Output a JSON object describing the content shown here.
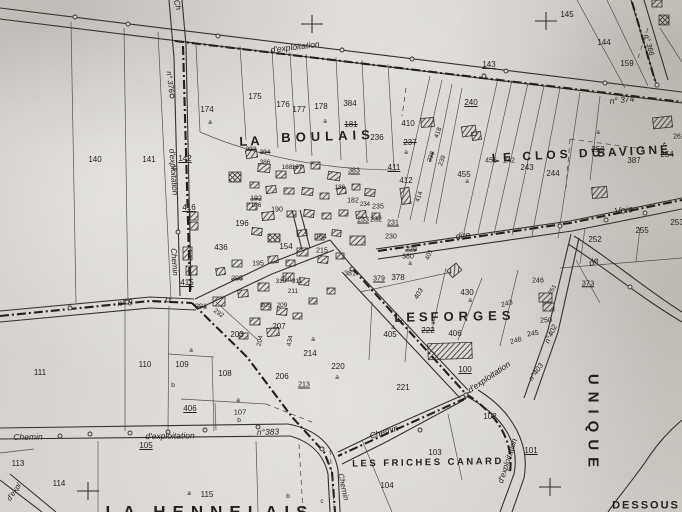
{
  "map": {
    "type": "cadastral-map-scan",
    "palette": {
      "paper": "#d6d4d0",
      "ink": "#2c2a25",
      "boundary": "#232019"
    },
    "place_labels": [
      {
        "text": "LA",
        "x": 251,
        "y": 141,
        "fs": 13,
        "ls": 3,
        "rot": -2
      },
      {
        "text": "BOULAIS",
        "x": 328,
        "y": 136,
        "fs": 13,
        "ls": 5,
        "rot": -2
      },
      {
        "text": "LE CLOS DU",
        "x": 548,
        "y": 155,
        "fs": 12,
        "ls": 4,
        "rot": -3
      },
      {
        "text": "SAVIGNÉ",
        "x": 634,
        "y": 151,
        "fs": 12,
        "ls": 3,
        "rot": -3
      },
      {
        "text": "LES",
        "x": 413,
        "y": 317,
        "fs": 13,
        "ls": 4,
        "rot": -1
      },
      {
        "text": "FORGES",
        "x": 473,
        "y": 316,
        "fs": 13,
        "ls": 5,
        "rot": -1
      },
      {
        "text": "LES FRICHES CANARD",
        "x": 428,
        "y": 463,
        "fs": 9.5,
        "ls": 2.5,
        "rot": -1
      },
      {
        "text": "LA HENNELAIS",
        "x": 210,
        "y": 512,
        "fs": 17,
        "ls": 7,
        "rot": 0
      },
      {
        "text": "UNIQUE",
        "x": 593,
        "y": 424,
        "fs": 15,
        "ls": 7,
        "rot": 90
      },
      {
        "text": "DESSOUS",
        "x": 646,
        "y": 506,
        "fs": 11,
        "ls": 2,
        "rot": 0
      }
    ],
    "road_labels": [
      {
        "text": "Ch",
        "x": 177,
        "y": 5,
        "fs": 8,
        "rot": 75
      },
      {
        "text": "d'exploitation",
        "x": 295,
        "y": 47,
        "fs": 8.5,
        "rot": -7
      },
      {
        "text": "n° 374",
        "x": 622,
        "y": 100,
        "fs": 8.5,
        "rot": -6
      },
      {
        "text": "n° 366",
        "x": 649,
        "y": 45,
        "fs": 7.5,
        "rot": 75
      },
      {
        "text": "n° 376",
        "x": 170,
        "y": 82,
        "fs": 7.5,
        "rot": 83
      },
      {
        "text": "d'exploitation",
        "x": 173,
        "y": 172,
        "fs": 8,
        "rot": 86
      },
      {
        "text": "Chemin",
        "x": 174,
        "y": 262,
        "fs": 8,
        "rot": 86
      },
      {
        "text": "n° 8",
        "x": 125,
        "y": 303,
        "fs": 8.5,
        "rot": -5
      },
      {
        "text": "Chemin",
        "x": 28,
        "y": 437,
        "fs": 8.5,
        "rot": -1
      },
      {
        "text": "d'exploitation",
        "x": 170,
        "y": 436,
        "fs": 8.5,
        "rot": -1
      },
      {
        "text": "n°383",
        "x": 268,
        "y": 432,
        "fs": 8.5,
        "rot": -2
      },
      {
        "text": "d'expl",
        "x": 14,
        "y": 492,
        "fs": 7.5,
        "rot": -55
      },
      {
        "text": "Chemin",
        "x": 384,
        "y": 432,
        "fs": 8.5,
        "rot": -17
      },
      {
        "text": "d'exploitation",
        "x": 489,
        "y": 377,
        "fs": 8.5,
        "rot": -34
      },
      {
        "text": "d'exploitation",
        "x": 508,
        "y": 461,
        "fs": 8,
        "rot": -72
      },
      {
        "text": "n°403",
        "x": 536,
        "y": 372,
        "fs": 7.5,
        "rot": -55
      },
      {
        "text": "n°402",
        "x": 551,
        "y": 334,
        "fs": 7.5,
        "rot": -65
      },
      {
        "text": "403",
        "x": 419,
        "y": 294,
        "fs": 7,
        "rot": -60
      },
      {
        "text": "Chemin",
        "x": 343,
        "y": 487,
        "fs": 8,
        "rot": 78
      },
      {
        "text": "dite",
        "x": 463,
        "y": 236,
        "fs": 9,
        "rot": -8
      },
      {
        "text": "Voie",
        "x": 624,
        "y": 211,
        "fs": 9.5,
        "rot": -9
      },
      {
        "text": "de",
        "x": 594,
        "y": 262,
        "fs": 9,
        "rot": -25
      }
    ],
    "parcel_labels": [
      {
        "text": "140",
        "x": 95,
        "y": 160
      },
      {
        "text": "141",
        "x": 149,
        "y": 160
      },
      {
        "text": "142",
        "x": 185,
        "y": 159,
        "deco": "und"
      },
      {
        "text": "174",
        "x": 207,
        "y": 110
      },
      {
        "text": "175",
        "x": 255,
        "y": 97
      },
      {
        "text": "176",
        "x": 283,
        "y": 105
      },
      {
        "text": "177",
        "x": 299,
        "y": 110
      },
      {
        "text": "178",
        "x": 321,
        "y": 107
      },
      {
        "text": "384",
        "x": 350,
        "y": 104
      },
      {
        "text": "181",
        "x": 351,
        "y": 125,
        "deco": "strike"
      },
      {
        "text": "236",
        "x": 377,
        "y": 138
      },
      {
        "text": "143",
        "x": 489,
        "y": 65,
        "deco": "und"
      },
      {
        "text": "145",
        "x": 567,
        "y": 15
      },
      {
        "text": "144",
        "x": 604,
        "y": 43
      },
      {
        "text": "159",
        "x": 627,
        "y": 64
      },
      {
        "text": "240",
        "x": 471,
        "y": 103,
        "deco": "und"
      },
      {
        "text": "410",
        "x": 408,
        "y": 124
      },
      {
        "text": "237",
        "x": 410,
        "y": 143,
        "deco": "strike"
      },
      {
        "text": "253",
        "x": 598,
        "y": 150,
        "deco": "strike"
      },
      {
        "text": "254",
        "x": 667,
        "y": 155,
        "deco": "strike"
      },
      {
        "text": "387",
        "x": 634,
        "y": 161
      },
      {
        "text": "456",
        "x": 491,
        "y": 161,
        "fs": 7
      },
      {
        "text": "242",
        "x": 509,
        "y": 161,
        "fs": 7
      },
      {
        "text": "243",
        "x": 527,
        "y": 168
      },
      {
        "text": "244",
        "x": 553,
        "y": 174
      },
      {
        "text": "455",
        "x": 464,
        "y": 175
      },
      {
        "text": "411",
        "x": 394,
        "y": 168,
        "deco": "und"
      },
      {
        "text": "412",
        "x": 406,
        "y": 181
      },
      {
        "text": "416",
        "x": 189,
        "y": 208,
        "deco": "und"
      },
      {
        "text": "436",
        "x": 221,
        "y": 248
      },
      {
        "text": "418",
        "x": 439,
        "y": 133,
        "fs": 6.5,
        "rot": -70
      },
      {
        "text": "238",
        "x": 432,
        "y": 157,
        "fs": 6.5,
        "rot": -70,
        "deco": "strike"
      },
      {
        "text": "239",
        "x": 443,
        "y": 161,
        "fs": 6.5,
        "rot": -70
      },
      {
        "text": "414",
        "x": 420,
        "y": 197,
        "fs": 6.5,
        "rot": -70
      },
      {
        "text": "393",
        "x": 251,
        "y": 150,
        "fs": 6.5,
        "deco": "strike"
      },
      {
        "text": "394",
        "x": 265,
        "y": 153,
        "fs": 6.5,
        "deco": "strike"
      },
      {
        "text": "386",
        "x": 265,
        "y": 163,
        "fs": 6.5
      },
      {
        "text": "188",
        "x": 287,
        "y": 168,
        "fs": 6.5
      },
      {
        "text": "187",
        "x": 297,
        "y": 168,
        "fs": 6.5
      },
      {
        "text": "383",
        "x": 354,
        "y": 171,
        "fs": 7,
        "deco": "und"
      },
      {
        "text": "186",
        "x": 340,
        "y": 188,
        "fs": 6.5
      },
      {
        "text": "192",
        "x": 256,
        "y": 199,
        "fs": 7,
        "deco": "strike"
      },
      {
        "text": "186",
        "x": 256,
        "y": 206,
        "fs": 6.5
      },
      {
        "text": "190",
        "x": 277,
        "y": 210,
        "fs": 7
      },
      {
        "text": "182",
        "x": 353,
        "y": 201,
        "fs": 7
      },
      {
        "text": "234",
        "x": 365,
        "y": 205,
        "fs": 6
      },
      {
        "text": "235",
        "x": 378,
        "y": 207,
        "fs": 7
      },
      {
        "text": "196",
        "x": 242,
        "y": 224
      },
      {
        "text": "184",
        "x": 321,
        "y": 237,
        "fs": 7
      },
      {
        "text": "215",
        "x": 322,
        "y": 251,
        "fs": 7
      },
      {
        "text": "233",
        "x": 363,
        "y": 220,
        "fs": 7,
        "deco": "und"
      },
      {
        "text": "232",
        "x": 376,
        "y": 220,
        "fs": 7
      },
      {
        "text": "231",
        "x": 393,
        "y": 223,
        "fs": 7,
        "deco": "und"
      },
      {
        "text": "230",
        "x": 391,
        "y": 237,
        "fs": 7
      },
      {
        "text": "229",
        "x": 411,
        "y": 250,
        "fs": 7,
        "deco": "strike"
      },
      {
        "text": "380",
        "x": 408,
        "y": 257,
        "fs": 7
      },
      {
        "text": "378",
        "x": 398,
        "y": 278
      },
      {
        "text": "379",
        "x": 379,
        "y": 279,
        "fs": 7,
        "deco": "und"
      },
      {
        "text": "381",
        "x": 350,
        "y": 274,
        "fs": 7
      },
      {
        "text": "401",
        "x": 430,
        "y": 255,
        "fs": 6.5,
        "rot": -70
      },
      {
        "text": "154",
        "x": 286,
        "y": 247
      },
      {
        "text": "195",
        "x": 258,
        "y": 264,
        "fs": 7
      },
      {
        "text": "295",
        "x": 237,
        "y": 279,
        "fs": 7,
        "deco": "strike"
      },
      {
        "text": "310",
        "x": 281,
        "y": 282,
        "fs": 6.5
      },
      {
        "text": "311",
        "x": 297,
        "y": 282,
        "fs": 6.5
      },
      {
        "text": "415",
        "x": 187,
        "y": 283,
        "deco": "und"
      },
      {
        "text": "291",
        "x": 201,
        "y": 307,
        "fs": 7,
        "deco": "strike"
      },
      {
        "text": "292",
        "x": 218,
        "y": 314,
        "fs": 6.5,
        "rot": 35
      },
      {
        "text": "210",
        "x": 286,
        "y": 280,
        "fs": 6.5
      },
      {
        "text": "211",
        "x": 293,
        "y": 292,
        "fs": 6.5
      },
      {
        "text": "205",
        "x": 266,
        "y": 306,
        "fs": 6.5
      },
      {
        "text": "209",
        "x": 282,
        "y": 306,
        "fs": 6.5
      },
      {
        "text": "207",
        "x": 279,
        "y": 327
      },
      {
        "text": "204",
        "x": 261,
        "y": 341,
        "fs": 6.5,
        "rot": -80
      },
      {
        "text": "434",
        "x": 291,
        "y": 341,
        "fs": 6.5,
        "rot": -80
      },
      {
        "text": "203",
        "x": 237,
        "y": 335
      },
      {
        "text": "206",
        "x": 282,
        "y": 377
      },
      {
        "text": "213",
        "x": 304,
        "y": 385,
        "fs": 7,
        "deco": "und"
      },
      {
        "text": "214",
        "x": 310,
        "y": 354
      },
      {
        "text": "220",
        "x": 338,
        "y": 367
      },
      {
        "text": "221",
        "x": 403,
        "y": 388
      },
      {
        "text": "100",
        "x": 465,
        "y": 370,
        "deco": "und"
      },
      {
        "text": "430",
        "x": 467,
        "y": 293
      },
      {
        "text": "405",
        "x": 390,
        "y": 335
      },
      {
        "text": "222",
        "x": 428,
        "y": 331,
        "deco": "strike"
      },
      {
        "text": "406",
        "x": 455,
        "y": 334
      },
      {
        "text": "243",
        "x": 507,
        "y": 304,
        "fs": 7,
        "rot": -15
      },
      {
        "text": "246",
        "x": 538,
        "y": 281,
        "fs": 7
      },
      {
        "text": "251",
        "x": 553,
        "y": 290,
        "fs": 6,
        "rot": -60
      },
      {
        "text": "250",
        "x": 546,
        "y": 321,
        "fs": 7
      },
      {
        "text": "245",
        "x": 533,
        "y": 334,
        "fs": 7,
        "rot": -10
      },
      {
        "text": "248",
        "x": 516,
        "y": 341,
        "fs": 7,
        "rot": -15
      },
      {
        "text": "373",
        "x": 588,
        "y": 283,
        "fs": 7.5,
        "deco": "und"
      },
      {
        "text": "252",
        "x": 595,
        "y": 240
      },
      {
        "text": "255",
        "x": 642,
        "y": 231
      },
      {
        "text": "253",
        "x": 677,
        "y": 223
      },
      {
        "text": "261",
        "x": 679,
        "y": 137,
        "fs": 7
      },
      {
        "text": "102",
        "x": 490,
        "y": 417
      },
      {
        "text": "103",
        "x": 435,
        "y": 453
      },
      {
        "text": "104",
        "x": 387,
        "y": 486
      },
      {
        "text": "101",
        "x": 531,
        "y": 451,
        "deco": "und"
      },
      {
        "text": "111",
        "x": 40,
        "y": 373
      },
      {
        "text": "110",
        "x": 145,
        "y": 365
      },
      {
        "text": "109",
        "x": 182,
        "y": 365
      },
      {
        "text": "108",
        "x": 225,
        "y": 374
      },
      {
        "text": "406",
        "x": 190,
        "y": 409,
        "deco": "und"
      },
      {
        "text": "107",
        "x": 240,
        "y": 412,
        "fs": 7.5
      },
      {
        "text": "113",
        "x": 18,
        "y": 464
      },
      {
        "text": "114",
        "x": 59,
        "y": 484
      },
      {
        "text": "115",
        "x": 207,
        "y": 495
      },
      {
        "text": "105",
        "x": 146,
        "y": 446,
        "deco": "und"
      }
    ],
    "sub_labels": [
      {
        "text": "a",
        "x": 210,
        "y": 123
      },
      {
        "text": "a",
        "x": 325,
        "y": 122
      },
      {
        "text": "a",
        "x": 406,
        "y": 153
      },
      {
        "text": "a",
        "x": 467,
        "y": 182
      },
      {
        "text": "a",
        "x": 598,
        "y": 133
      },
      {
        "text": "a",
        "x": 470,
        "y": 301
      },
      {
        "text": "a",
        "x": 433,
        "y": 323
      },
      {
        "text": "a",
        "x": 393,
        "y": 328
      },
      {
        "text": "a",
        "x": 313,
        "y": 340
      },
      {
        "text": "a",
        "x": 337,
        "y": 378
      },
      {
        "text": "a",
        "x": 410,
        "y": 264
      },
      {
        "text": "a",
        "x": 191,
        "y": 351
      },
      {
        "text": "b",
        "x": 173,
        "y": 386
      },
      {
        "text": "a",
        "x": 238,
        "y": 401
      },
      {
        "text": "b",
        "x": 239,
        "y": 421
      },
      {
        "text": "a",
        "x": 189,
        "y": 494
      },
      {
        "text": "b",
        "x": 288,
        "y": 497
      },
      {
        "text": "c",
        "x": 322,
        "y": 502
      }
    ],
    "crosses": [
      {
        "x": 312,
        "y": 24
      },
      {
        "x": 546,
        "y": 21
      },
      {
        "x": 88,
        "y": 491
      },
      {
        "x": 550,
        "y": 487
      }
    ]
  }
}
